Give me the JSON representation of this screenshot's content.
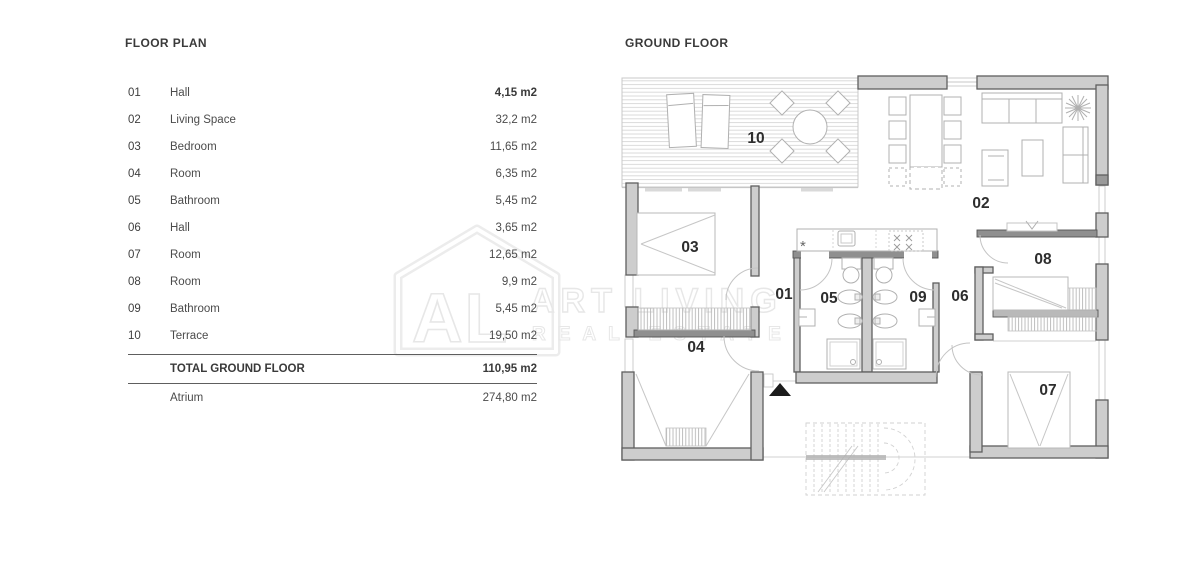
{
  "left_panel": {
    "title": "FLOOR PLAN",
    "rows": [
      {
        "num": "01",
        "name": "Hall",
        "area": "4,15 m2"
      },
      {
        "num": "02",
        "name": "Living Space",
        "area": "32,2 m2"
      },
      {
        "num": "03",
        "name": "Bedroom",
        "area": "11,65 m2"
      },
      {
        "num": "04",
        "name": "Room",
        "area": "6,35 m2"
      },
      {
        "num": "05",
        "name": "Bathroom",
        "area": "5,45 m2"
      },
      {
        "num": "06",
        "name": "Hall",
        "area": "3,65 m2"
      },
      {
        "num": "07",
        "name": "Room",
        "area": "12,65 m2"
      },
      {
        "num": "08",
        "name": "Room",
        "area": "9,9 m2"
      },
      {
        "num": "09",
        "name": "Bathroom",
        "area": "5,45 m2"
      },
      {
        "num": "10",
        "name": "Terrace",
        "area": "19,50 m2"
      }
    ],
    "total_row": {
      "label": "TOTAL GROUND FLOOR",
      "area": "110,95 m2"
    },
    "atrium_row": {
      "label": "Atrium",
      "area": "274,80 m2"
    }
  },
  "plan": {
    "title": "GROUND FLOOR",
    "labels": {
      "r01": "01",
      "r02": "02",
      "r03": "03",
      "r04": "04",
      "r05": "05",
      "r06": "06",
      "r07": "07",
      "r08": "08",
      "r09": "09",
      "r10": "10"
    },
    "symbols": {
      "kitchen_star": "*"
    }
  },
  "watermark": {
    "logo_text": "AL",
    "line1": "ART LIVING",
    "line2": "REAL ESTATE"
  },
  "colors": {
    "wall": "#cdcdcd",
    "wall_dark": "#8f8f8f",
    "wall_edge": "#5f5f5f",
    "furniture_line": "#b0b0b0",
    "watermark": "#e7e7e7",
    "table_text": "#4b4b4b",
    "room_label": "#2d2d2d",
    "arrow": "#1c1c1c"
  }
}
